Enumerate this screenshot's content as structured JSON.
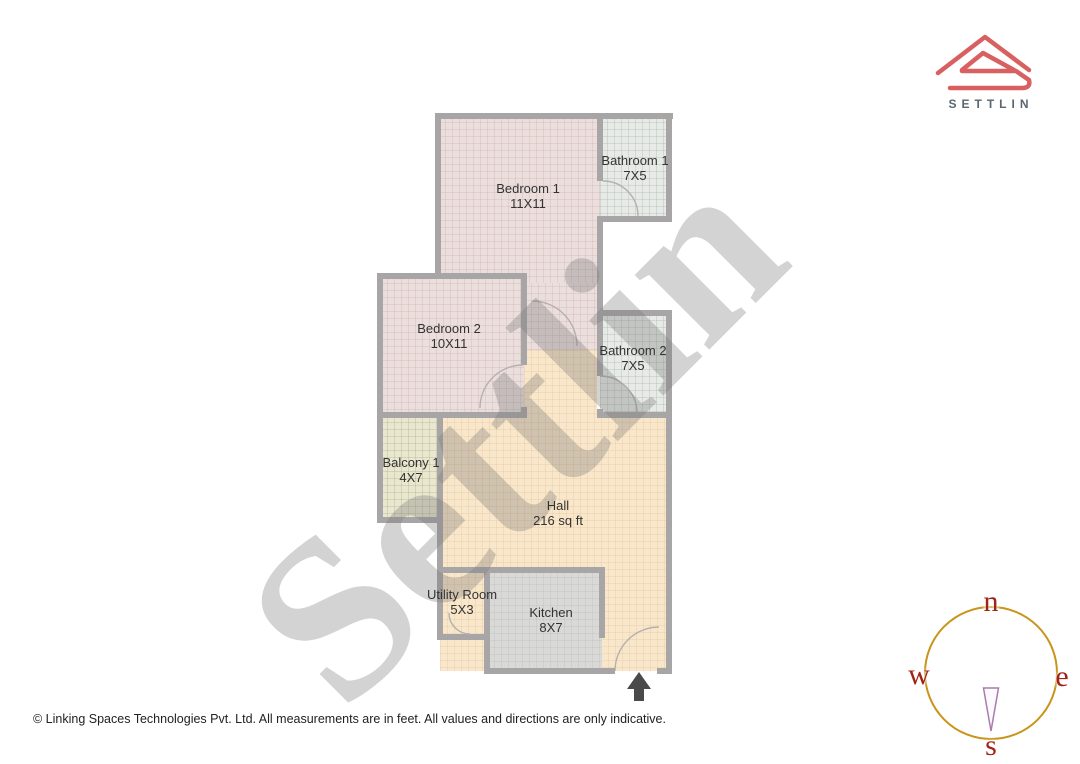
{
  "logo": {
    "brand": "SETTLIN"
  },
  "watermark": {
    "text": "Settlin"
  },
  "rooms": [
    {
      "name": "Bedroom 1",
      "dims": "11X11"
    },
    {
      "name": "Bathroom 1",
      "dims": "7X5"
    },
    {
      "name": "Bedroom 2",
      "dims": "10X11"
    },
    {
      "name": "Bathroom 2",
      "dims": "7X5"
    },
    {
      "name": "Balcony 1",
      "dims": "4X7"
    },
    {
      "name": "Hall",
      "dims": "216 sq ft"
    },
    {
      "name": "Utility Room",
      "dims": "5X3"
    },
    {
      "name": "Kitchen",
      "dims": "8X7"
    }
  ],
  "compass": {
    "n": "n",
    "e": "e",
    "s": "s",
    "w": "w"
  },
  "footer": {
    "text": "© Linking Spaces Technologies Pvt. Ltd. All measurements are in feet. All values and directions are only indicative."
  },
  "colors": {
    "logo_red": "#d96060",
    "brand_gray": "#5c6670",
    "wall_gray": "#a8a5a6",
    "bedroom_fill": "#ebdfdd",
    "bathroom_fill": "#e7eae7",
    "hall_fill": "#f9e7cb",
    "kitchen_fill": "#d9d9d7",
    "balcony_fill": "#e9e7d0",
    "compass_ring_gold": "#c9941a",
    "compass_letter_red": "#a02315",
    "entrance_arrow_gray": "#4a4a4a",
    "watermark_gray": "#787878"
  }
}
